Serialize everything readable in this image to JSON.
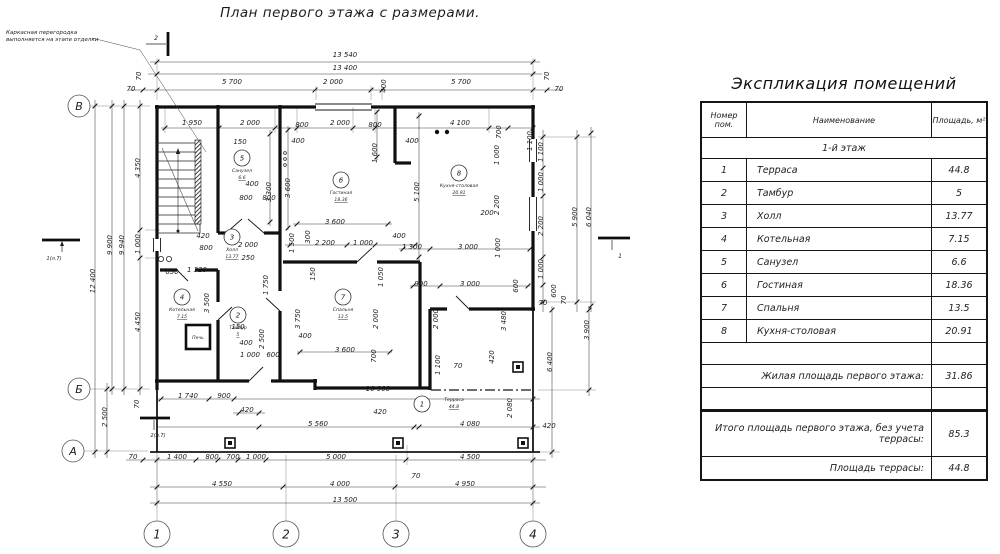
{
  "plan": {
    "title": "План первого этажа с размерами.",
    "note_line1": "Каркасная перегородка",
    "note_line2": "выполняется на этапе отделки",
    "axis_rows": [
      "В",
      "Б",
      "А"
    ],
    "axis_cols": [
      "1",
      "2",
      "3",
      "4"
    ],
    "section_marks": [
      "2",
      "1(л.7)",
      "2(л.7)",
      "1"
    ],
    "stove_label": "Печь",
    "dim_texts": [
      "13 540",
      "13 400",
      "5 700",
      "2 000",
      "400",
      "5 700",
      "70",
      "70",
      "70",
      "70",
      "1 950",
      "2 000",
      "800",
      "2 000",
      "800",
      "4 100",
      "700",
      "1 100",
      "150",
      "400",
      "400",
      "1 600",
      "3 300",
      "3 600",
      "400",
      "800",
      "800",
      "5 100",
      "1 000",
      "2 200",
      "200",
      "1 000",
      "400",
      "1 300",
      "3 000",
      "3 600",
      "1 500",
      "300",
      "2 200",
      "1 000",
      "1 050",
      "900",
      "3 000",
      "600",
      "2 000",
      "250",
      "420",
      "800",
      "1 750",
      "630",
      "1 320",
      "3 500",
      "150",
      "400",
      "2 500",
      "1 000",
      "600",
      "150",
      "3 750",
      "400",
      "2 000",
      "3 600",
      "700",
      "2 000",
      "3 480",
      "1 100",
      "70",
      "420",
      "4 350",
      "1 000",
      "4 450",
      "9 900",
      "9 940",
      "12 400",
      "2 500",
      "70",
      "1 100",
      "1 000",
      "2 200",
      "1 000",
      "600",
      "5 900",
      "6 040",
      "70",
      "70",
      "3 900",
      "6 400",
      "2 080",
      "420",
      "1 740",
      "900",
      "10 900",
      "420",
      "5 560",
      "420",
      "4 080",
      "70",
      "1 400",
      "800",
      "700",
      "1 000",
      "5 000",
      "4 500",
      "70",
      "4 550",
      "4 000",
      "4 950",
      "13 500"
    ],
    "rooms": [
      {
        "num": "1",
        "name": "Терраса",
        "area": "44.8"
      },
      {
        "num": "2",
        "name": "Тамбур",
        "area": "5"
      },
      {
        "num": "3",
        "name": "Холл",
        "area": "13.77"
      },
      {
        "num": "4",
        "name": "Котельная",
        "area": "7.15"
      },
      {
        "num": "5",
        "name": "Санузел",
        "area": "6.6"
      },
      {
        "num": "6",
        "name": "Гостиная",
        "area": "18.36"
      },
      {
        "num": "7",
        "name": "Спальня",
        "area": "13.5"
      },
      {
        "num": "8",
        "name": "Кухня-столовая",
        "area": "20.91"
      }
    ]
  },
  "table": {
    "title": "Экспликация помещений",
    "col_headers": [
      "Номер пом.",
      "Наименование",
      "Площадь, м²"
    ],
    "section": "1-й этаж",
    "rows": [
      [
        "1",
        "Терраса",
        "44.8"
      ],
      [
        "2",
        "Тамбур",
        "5"
      ],
      [
        "3",
        "Холл",
        "13.77"
      ],
      [
        "4",
        "Котельная",
        "7.15"
      ],
      [
        "5",
        "Санузел",
        "6.6"
      ],
      [
        "6",
        "Гостиная",
        "18.36"
      ],
      [
        "7",
        "Спальня",
        "13.5"
      ],
      [
        "8",
        "Кухня-столовая",
        "20.91"
      ]
    ],
    "summary": [
      {
        "label": "Жилая площадь первого этажа:",
        "value": "31.86"
      },
      {
        "label": "Итого площадь первого этажа, без учета террасы:",
        "value": "85.3"
      },
      {
        "label": "Площадь террасы:",
        "value": "44.8"
      }
    ]
  }
}
